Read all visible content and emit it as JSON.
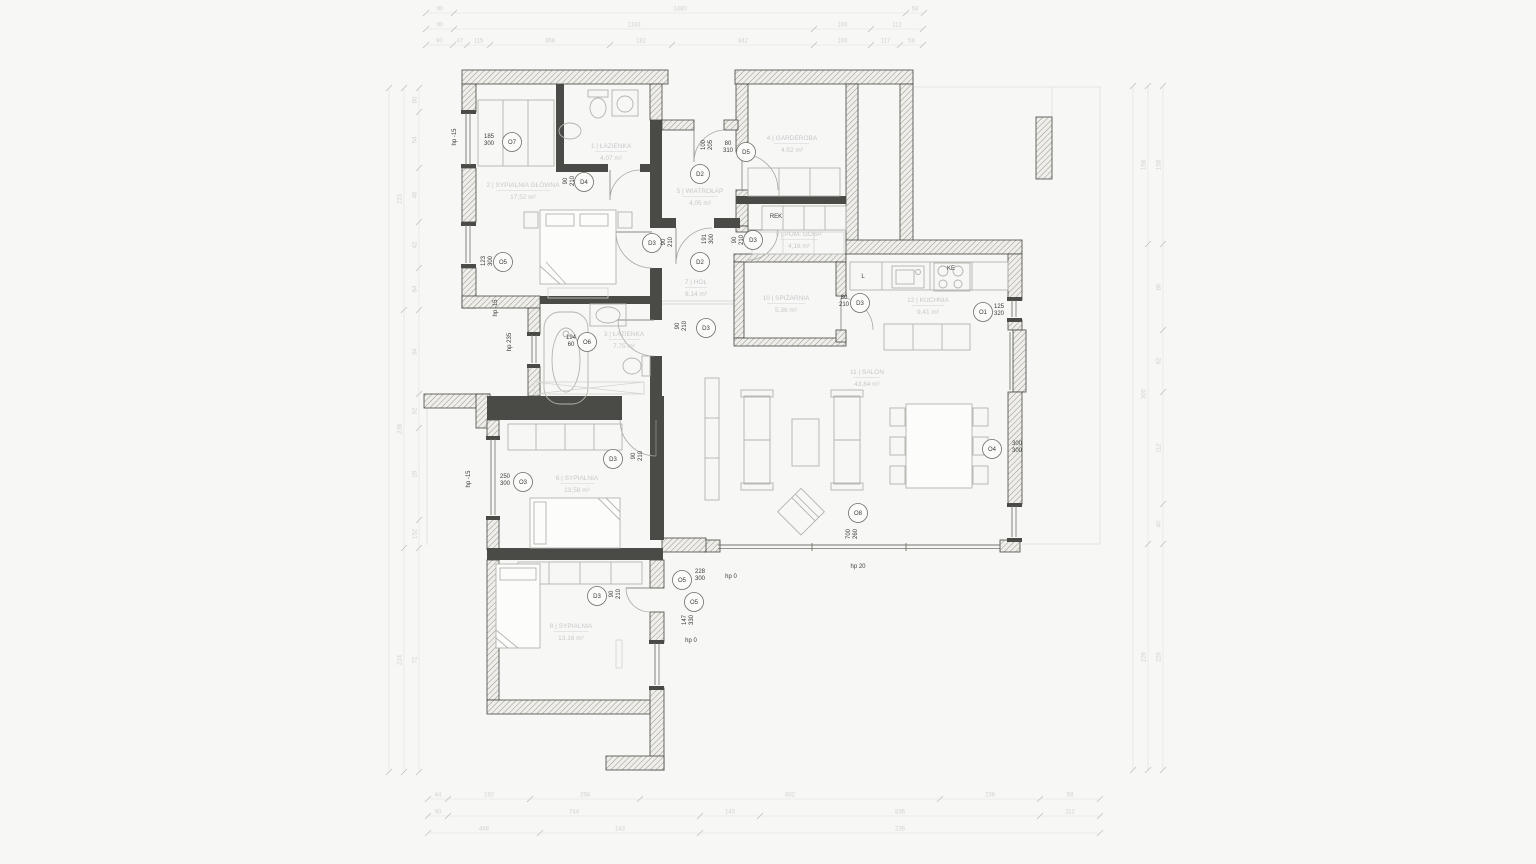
{
  "drawing": {
    "type": "architectural-floor-plan",
    "rooms": [
      {
        "name": "1 | ŁAZIENKA",
        "area": "4,07 m²"
      },
      {
        "name": "2 | SYPIALNIA GŁÓWNA",
        "area": "17,52 m²"
      },
      {
        "name": "3 | ŁAZIENKA",
        "area": "7,75 m²"
      },
      {
        "name": "4 | GARDEROBA",
        "area": "4,52 m²"
      },
      {
        "name": "5 | WIATROŁAP",
        "area": "4,05 m²"
      },
      {
        "name": "6 | SYPIALNIA",
        "area": "13,58 m²"
      },
      {
        "name": "7 | HOL",
        "area": "8,14 m²"
      },
      {
        "name": "8 | SYPIALNIA",
        "area": "13,16 m²"
      },
      {
        "name": "9 | POM. GOSP.",
        "area": "4,16 m²"
      },
      {
        "name": "10 | SPIŻARNIA",
        "area": "5,36 m²"
      },
      {
        "name": "11 | SALON",
        "area": "43,84 m²"
      },
      {
        "name": "12 | KUCHNIA",
        "area": "9,41 m²"
      }
    ],
    "openings": [
      {
        "ref": "O7",
        "dim": "185/300"
      },
      {
        "ref": "D4",
        "dim": "90/210"
      },
      {
        "ref": "O5",
        "dim": "123/300"
      },
      {
        "ref": "D3",
        "dim": "90/210"
      },
      {
        "ref": "D2",
        "dim": "100/205"
      },
      {
        "ref": "D5",
        "dim": "80/310"
      },
      {
        "ref": "D2",
        "dim": "191/300"
      },
      {
        "ref": "D3",
        "dim": "90/210"
      },
      {
        "ref": "D3",
        "dim": "80/210"
      },
      {
        "ref": "O6",
        "dim": "194/60"
      },
      {
        "ref": "D3",
        "dim": "90/210"
      },
      {
        "ref": "O1",
        "dim": "125/320"
      },
      {
        "ref": "O4",
        "dim": "300/300"
      },
      {
        "ref": "O8",
        "dim": "700/260"
      },
      {
        "ref": "O3",
        "dim": "250/300"
      },
      {
        "ref": "D3",
        "dim": "90/210"
      },
      {
        "ref": "D3",
        "dim": "90/210"
      },
      {
        "ref": "O5",
        "dim": "228/300"
      },
      {
        "ref": "O5",
        "dim": "147/330"
      }
    ],
    "annotations": [
      "hp -15",
      "hp -15",
      "hp 235",
      "hp -15",
      "hp 0",
      "hp 0",
      "hp 20",
      "REK",
      "L",
      "KE"
    ],
    "chains": {
      "top": [
        [
          "90",
          "1480",
          "58"
        ],
        [
          "90",
          "1183",
          "183",
          "112"
        ],
        [
          "90",
          "47",
          "115",
          "368",
          "182",
          "842",
          "183",
          "117",
          "58"
        ]
      ],
      "bottom": [
        [
          "44",
          "192",
          "298",
          "802",
          "238",
          "58"
        ],
        [
          "90",
          "744",
          "143",
          "836",
          "112"
        ],
        [
          "448",
          "143",
          "236"
        ]
      ],
      "left": [
        [],
        [
          "223",
          "238",
          "224"
        ],
        [
          "80",
          "54",
          "46",
          "42",
          "84",
          "34",
          "92",
          "28",
          "152",
          "72"
        ]
      ],
      "right": [
        [],
        [
          "158",
          "300",
          "226"
        ],
        [
          "158",
          "86",
          "62",
          "112",
          "40",
          "226"
        ]
      ]
    }
  }
}
